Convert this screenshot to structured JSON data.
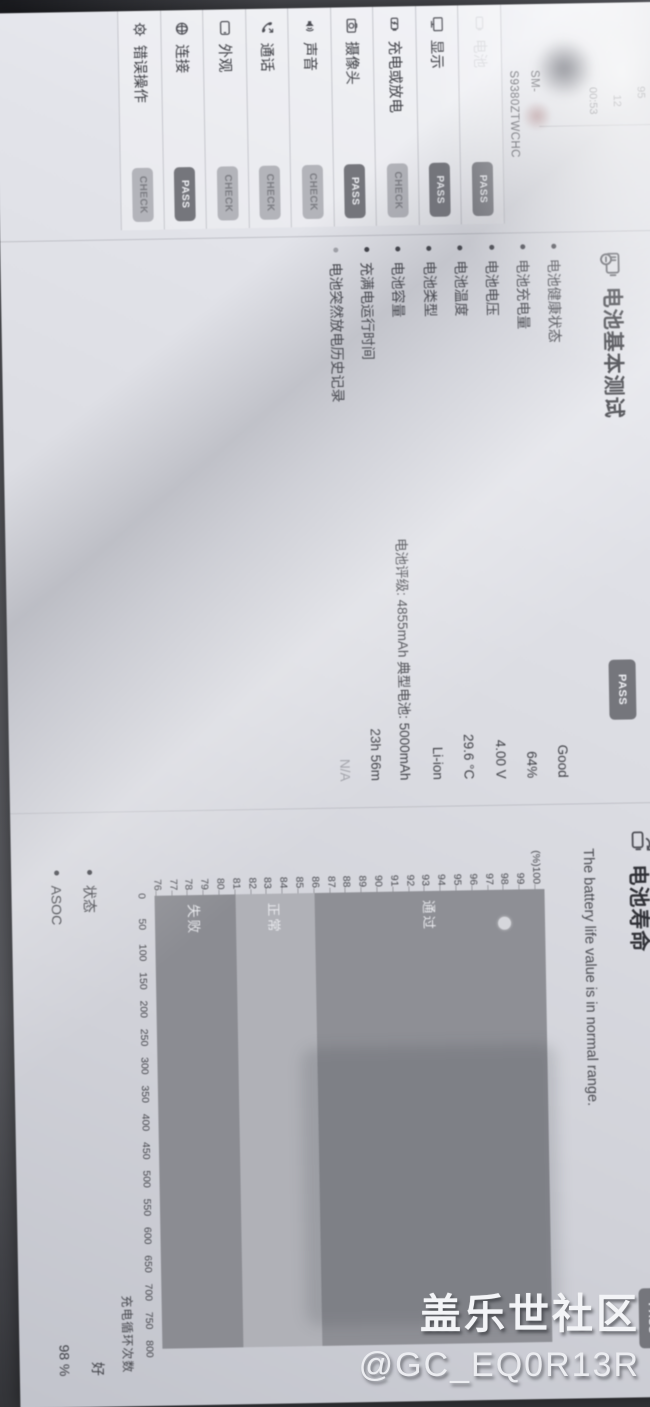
{
  "photo": {
    "watermark": {
      "line1": "盖乐世社区",
      "line2": "@GC_EQ0R13R"
    }
  },
  "report": {
    "header": {
      "stat1": "95",
      "stat2": "12",
      "time": "00:53",
      "model_line1": "SM-",
      "model_line2": "S9380ZTWCHC"
    },
    "categories": [
      {
        "label": "电池",
        "status": "PASS",
        "icon": "battery-icon",
        "washed_out": true
      },
      {
        "label": "显示",
        "status": "PASS",
        "icon": "display-icon"
      },
      {
        "label": "充电或放电",
        "status": "CHECK",
        "icon": "charge-icon"
      },
      {
        "label": "摄像头",
        "status": "PASS",
        "icon": "camera-icon"
      },
      {
        "label": "声音",
        "status": "CHECK",
        "icon": "sound-icon"
      },
      {
        "label": "通话",
        "status": "CHECK",
        "icon": "call-icon"
      },
      {
        "label": "外观",
        "status": "CHECK",
        "icon": "appearance-icon"
      },
      {
        "label": "连接",
        "status": "PASS",
        "icon": "connection-icon"
      },
      {
        "label": "错误操作",
        "status": "CHECK",
        "icon": "error-icon"
      }
    ],
    "battery_basic": {
      "title": "电池基本测试",
      "status": "PASS",
      "items": [
        {
          "label": "电池健康状态",
          "value": "Good"
        },
        {
          "label": "电池充电量",
          "value": "64%"
        },
        {
          "label": "电池电压",
          "value": "4.00 V"
        },
        {
          "label": "电池温度",
          "value": "29.6 °C"
        },
        {
          "label": "电池类型",
          "value": "Li-ion"
        },
        {
          "label": "电池容量",
          "value": "电池评级: 4855mAh 典型电池: 5000mAh"
        },
        {
          "label": "充满电运行时间",
          "value": "23h 56m"
        },
        {
          "label": "电池突然放电历史记录",
          "value": "N/A",
          "muted": true
        }
      ]
    },
    "battery_life": {
      "title": "电池寿命",
      "status": "PASS",
      "description": "The battery life value is in normal range.",
      "stats": [
        {
          "label": "状态",
          "value": "好"
        },
        {
          "label": "ASOC",
          "value": "98 %"
        }
      ]
    }
  },
  "chart_data": {
    "type": "scatter",
    "title": "电池寿命",
    "xlabel": "充电循环次数",
    "y_unit": "(%)",
    "xlim": [
      0,
      800
    ],
    "ylim": [
      76,
      100
    ],
    "x_ticks": [
      0,
      50,
      100,
      150,
      200,
      250,
      300,
      350,
      400,
      450,
      500,
      550,
      600,
      650,
      700,
      750,
      800
    ],
    "y_ticks": [
      100,
      99,
      98,
      97,
      96,
      95,
      94,
      93,
      92,
      91,
      90,
      89,
      88,
      87,
      86,
      85,
      84,
      83,
      82,
      81,
      80,
      79,
      78,
      77,
      76
    ],
    "zones": [
      {
        "label": "通过",
        "from": 86,
        "to": 100.6,
        "color": "#8e8f95"
      },
      {
        "label": "正常",
        "from": 81,
        "to": 86,
        "color": "#b0b1b7"
      },
      {
        "label": "失败",
        "from": 76,
        "to": 81,
        "color": "#8b8c92"
      }
    ],
    "points": [
      {
        "x": 60,
        "y": 98
      }
    ],
    "point_color": "#d6d7dc",
    "grid": false,
    "legend_position": "zone labels inside plot, left"
  }
}
